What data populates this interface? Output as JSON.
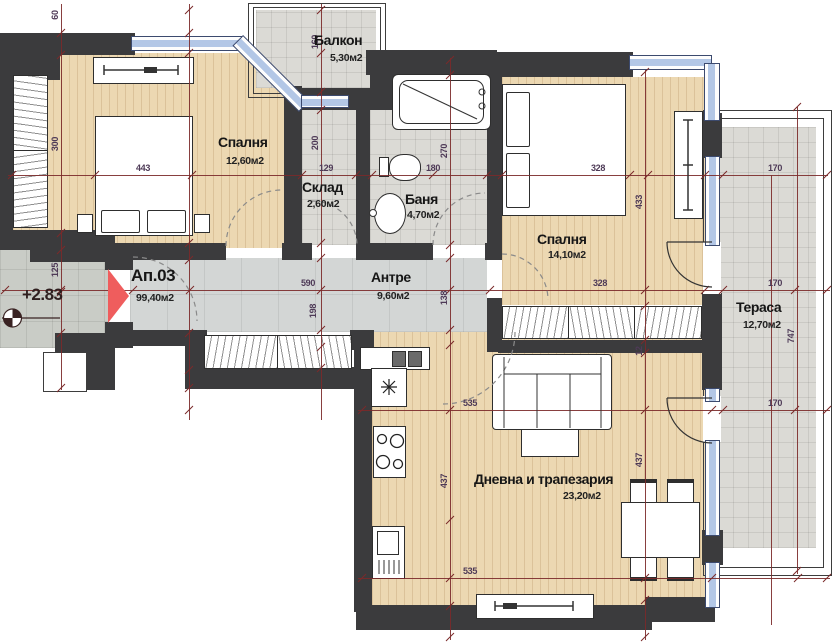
{
  "plan": {
    "apartment_label": {
      "number": "Ап.03",
      "area": "99,40м2"
    },
    "elevation_marker": {
      "value": "+2.83"
    },
    "rooms": {
      "balcony": {
        "name": "Балкон",
        "area": "5,30м2"
      },
      "bedroom1": {
        "name": "Спалня",
        "area": "12,60м2"
      },
      "storage": {
        "name": "Склад",
        "area": "2,60м2"
      },
      "bathroom": {
        "name": "Баня",
        "area": "4,70м2"
      },
      "bedroom2": {
        "name": "Спалня",
        "area": "14,10м2"
      },
      "hallway": {
        "name": "Антре",
        "area": "9,60м2"
      },
      "living": {
        "name": "Дневна и трапезария",
        "area": "23,20м2"
      },
      "terrace": {
        "name": "Тераса",
        "area": "12,70м2"
      }
    },
    "dims": {
      "d60": "60",
      "d300": "300",
      "d125": "125",
      "d443": "443",
      "d129": "129",
      "d180": "180",
      "d328_top": "328",
      "d170_top": "170",
      "d160": "160",
      "d200": "200",
      "d198": "198",
      "d590": "590",
      "d328_mid": "328",
      "d170_mid": "170",
      "d270": "270",
      "d138": "138",
      "d437_kitchen": "437",
      "d433": "433",
      "d12": "12",
      "d437_living": "437",
      "d535_top": "535",
      "d170_bottom": "170",
      "d535_bottom": "535",
      "d747": "747"
    },
    "colors": {
      "wall": "#3b3b3d",
      "window_glass": "#b3c7e6",
      "wood_floor": "#ecd8b2",
      "tile_floor": "#dbdad5",
      "hall_tile": "#d3d6d5",
      "dimension_line": "#7b2a2a",
      "entrance_arrow": "#ef5d5d"
    }
  }
}
